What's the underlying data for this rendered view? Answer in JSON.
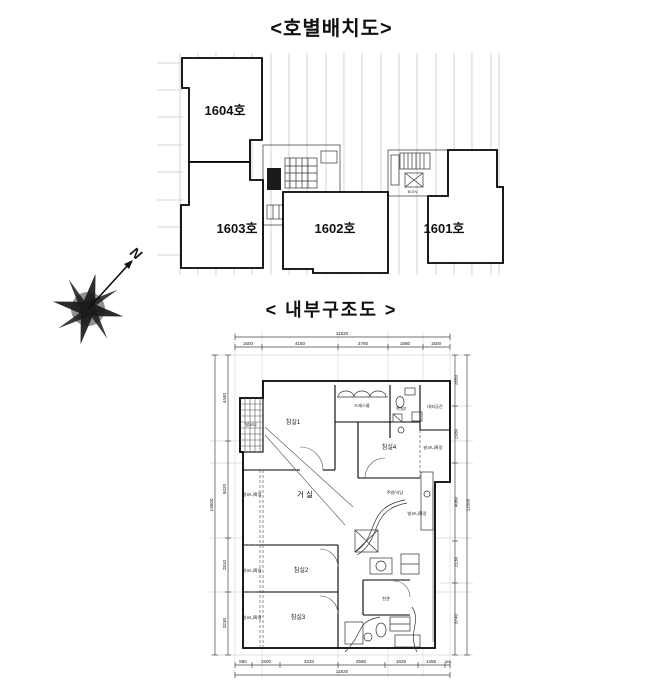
{
  "unit_layout": {
    "title": "<호별배치도>",
    "highlight_color": "#f3dfdf",
    "units": {
      "u1604": "1604호",
      "u1603": "1603호",
      "u1602": "1602호",
      "u1601": "1601호"
    },
    "elev_label": "ELEV."
  },
  "compass": {
    "north": "N"
  },
  "floor_plan": {
    "title": "< 내부구조도 >",
    "rooms": {
      "balcony": "발코니",
      "bedroom1": "침실1",
      "dressroom": "드레스룸",
      "bath2": "욕실2",
      "evac": "대피공간",
      "bedroom4": "침실4",
      "living": "거 실",
      "kitchen": "주방/식당",
      "bedroom2": "침실2",
      "bedroom3": "침실3",
      "entrance": "현관",
      "balcony_ext": "발코니확장"
    },
    "dims": {
      "top_total": "11820",
      "top_segments": [
        "1500",
        "4160",
        "2780",
        "1880",
        "1500"
      ],
      "bottom_segments": [
        "960",
        "1500",
        "3220",
        "2560",
        "1825",
        "1455",
        "300"
      ],
      "bottom_total": "11820",
      "left_segments": [
        "4440",
        "5020",
        "2810",
        "3230"
      ],
      "left_total": "13500",
      "right_segments": [
        "2650",
        "2930",
        "4060",
        "2130",
        "3740"
      ],
      "right_total": "11500"
    }
  }
}
